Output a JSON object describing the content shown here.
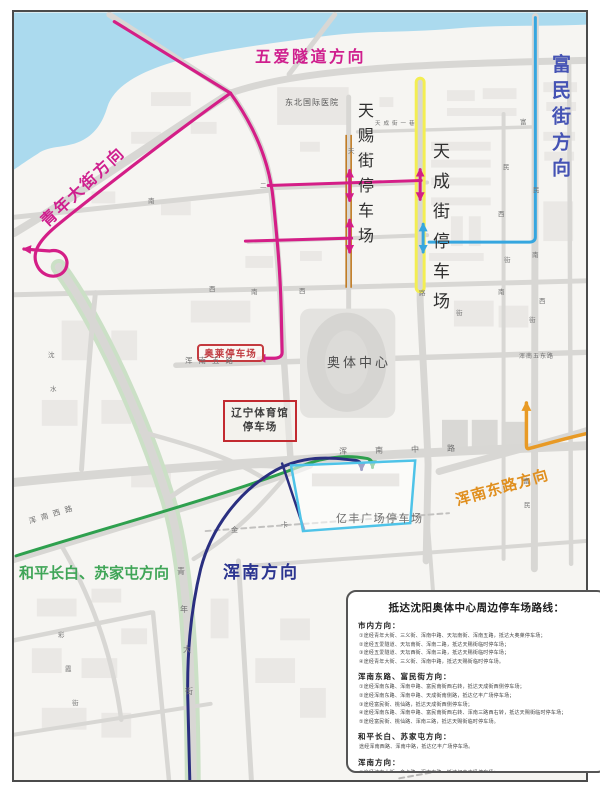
{
  "colors": {
    "route_magenta": "#d41e87",
    "route_blue": "#36a6df",
    "route_navy": "#2a2f80",
    "route_green": "#2ea04e",
    "route_orange": "#e89a25",
    "tianci_highlight_orange": "#c07a20",
    "tiancheng_highlight_yellow": "#f3ee52",
    "parking_box_red": "#c22a30",
    "yifeng_box_cyan": "#4ec3e8",
    "water": "#abdaee",
    "road": "#d8d7d4"
  },
  "map": {
    "parking": {
      "aolai": "奥莱停车场",
      "liaoning_line1": "辽宁体育馆",
      "liaoning_line2": "停车场",
      "yifeng": "亿丰广场停车场"
    },
    "labels": [
      {
        "name": "wuai-tunnel-direction-label",
        "text": "五爱隧道方向",
        "x": 253,
        "y": 47,
        "size": 16,
        "color": "#cf1f8e",
        "w": 700,
        "ls": 2.5
      },
      {
        "name": "fumin-street-direction-label",
        "text": "富民街方向",
        "x": 548,
        "y": 52,
        "size": 19,
        "color": "#4553b4",
        "w": 700,
        "ls": 7,
        "vert": true
      },
      {
        "name": "qingnian-street-direction-label",
        "text": "青年大街方向",
        "x": 36,
        "y": 216,
        "size": 16,
        "color": "#cf1f8e",
        "w": 700,
        "ls": 2,
        "rot": -43
      },
      {
        "name": "hunnan-east-road-direction-label",
        "text": "浑南东路方向",
        "x": 452,
        "y": 492,
        "size": 15,
        "color": "#e08f1f",
        "w": 700,
        "ls": 1,
        "rot": -16
      },
      {
        "name": "heping-changbai-sujiatun-direction-label",
        "text": "和平长白、苏家屯方向",
        "x": 17,
        "y": 564,
        "size": 15,
        "color": "#3fa557",
        "w": 700,
        "ls": 0
      },
      {
        "name": "hunnan-direction-label",
        "text": "浑南方向",
        "x": 221,
        "y": 563,
        "size": 17,
        "color": "#2c3590",
        "w": 700,
        "ls": 2
      },
      {
        "name": "tianci-street-parking-label",
        "text": "天赐街停车场",
        "x": 354,
        "y": 100,
        "size": 16,
        "color": "#2f2f2f",
        "w": 400,
        "ls": 9,
        "vert": true
      },
      {
        "name": "tiancheng-street-parking-label",
        "text": "天成街停车场",
        "x": 428,
        "y": 140,
        "size": 17,
        "color": "#2f2f2f",
        "w": 400,
        "ls": 13,
        "vert": true
      },
      {
        "name": "olympic-center-label",
        "text": "奥体中心",
        "x": 325,
        "y": 355,
        "size": 13,
        "color": "#4d4d4d",
        "w": 400,
        "ls": 3
      },
      {
        "name": "hospital-label",
        "text": "东北国际医院",
        "x": 283,
        "y": 97,
        "size": 8,
        "color": "#555555",
        "w": 400,
        "ls": 1
      },
      {
        "name": "road-label-hunnan-wulu",
        "text": "浑南五路",
        "x": 183,
        "y": 355,
        "size": 7.5,
        "color": "#6e6e6e",
        "w": 400,
        "ls": 6
      },
      {
        "name": "road-label-hunnan-wudonglu",
        "text": "浑南五东路",
        "x": 517,
        "y": 352,
        "size": 6,
        "color": "#6e6e6e",
        "w": 400,
        "ls": 1
      },
      {
        "name": "road-label-hunnan-zhonglu",
        "text": "浑南中路",
        "x": 337,
        "y": 446,
        "size": 8,
        "color": "#6e6e6e",
        "w": 400,
        "ls": 28,
        "rot": -1.5
      },
      {
        "name": "road-label-hunnan-xilu",
        "text": "浑南西路",
        "x": 26,
        "y": 516,
        "size": 7.5,
        "color": "#6e6e6e",
        "w": 400,
        "ls": 5,
        "rot": -17
      },
      {
        "name": "road-label-tiancheng-yixiang",
        "text": "天成街一巷",
        "x": 373,
        "y": 120,
        "size": 5.5,
        "color": "#6e6e6e",
        "w": 400,
        "ls": 3
      },
      {
        "name": "road-char",
        "text": "天",
        "x": 346,
        "y": 146,
        "size": 6.5,
        "color": "#757575"
      },
      {
        "name": "road-char",
        "text": "南",
        "x": 146,
        "y": 196,
        "size": 6.5,
        "color": "#757575"
      },
      {
        "name": "road-char",
        "text": "二",
        "x": 258,
        "y": 181,
        "size": 6.5,
        "color": "#757575"
      },
      {
        "name": "road-char",
        "text": "西",
        "x": 207,
        "y": 284,
        "size": 6.5,
        "color": "#757575"
      },
      {
        "name": "road-char",
        "text": "南",
        "x": 249,
        "y": 287,
        "size": 6.5,
        "color": "#757575"
      },
      {
        "name": "road-char",
        "text": "西",
        "x": 297,
        "y": 286,
        "size": 6.5,
        "color": "#757575"
      },
      {
        "name": "road-char",
        "text": "路",
        "x": 417,
        "y": 288,
        "size": 6.5,
        "color": "#757575"
      },
      {
        "name": "road-char",
        "text": "街",
        "x": 454,
        "y": 308,
        "size": 6.5,
        "color": "#757575"
      },
      {
        "name": "road-char",
        "text": "南",
        "x": 496,
        "y": 287,
        "size": 6.5,
        "color": "#757575"
      },
      {
        "name": "road-char",
        "text": "西",
        "x": 537,
        "y": 296,
        "size": 6.5,
        "color": "#757575"
      },
      {
        "name": "road-char",
        "text": "富",
        "x": 518,
        "y": 117,
        "size": 6.5,
        "color": "#757575"
      },
      {
        "name": "road-char",
        "text": "民",
        "x": 501,
        "y": 162,
        "size": 6.5,
        "color": "#757575"
      },
      {
        "name": "road-char",
        "text": "西",
        "x": 496,
        "y": 209,
        "size": 6.5,
        "color": "#757575"
      },
      {
        "name": "road-char",
        "text": "街",
        "x": 502,
        "y": 255,
        "size": 6.5,
        "color": "#757575"
      },
      {
        "name": "road-char",
        "text": "民",
        "x": 531,
        "y": 185,
        "size": 6.5,
        "color": "#757575"
      },
      {
        "name": "road-char",
        "text": "南",
        "x": 530,
        "y": 250,
        "size": 6.5,
        "color": "#757575"
      },
      {
        "name": "road-char",
        "text": "富",
        "x": 521,
        "y": 476,
        "size": 6.5,
        "color": "#757575"
      },
      {
        "name": "road-char",
        "text": "民",
        "x": 522,
        "y": 500,
        "size": 6.5,
        "color": "#757575"
      },
      {
        "name": "road-char",
        "text": "街",
        "x": 527,
        "y": 315,
        "size": 6.5,
        "color": "#757575"
      },
      {
        "name": "road-char",
        "text": "金",
        "x": 229,
        "y": 525,
        "size": 7,
        "color": "#757575"
      },
      {
        "name": "road-char",
        "text": "卡",
        "x": 279,
        "y": 520,
        "size": 7,
        "color": "#757575"
      },
      {
        "name": "road-char",
        "text": "青",
        "x": 175,
        "y": 566,
        "size": 8,
        "color": "#757575"
      },
      {
        "name": "road-char",
        "text": "年",
        "x": 178,
        "y": 604,
        "size": 8,
        "color": "#757575"
      },
      {
        "name": "road-char",
        "text": "大",
        "x": 181,
        "y": 644,
        "size": 8,
        "color": "#757575"
      },
      {
        "name": "road-char",
        "text": "街",
        "x": 183,
        "y": 686,
        "size": 8,
        "color": "#757575"
      },
      {
        "name": "road-char",
        "text": "彩",
        "x": 56,
        "y": 630,
        "size": 6.5,
        "color": "#757575"
      },
      {
        "name": "road-char",
        "text": "霞",
        "x": 63,
        "y": 664,
        "size": 6.5,
        "color": "#757575"
      },
      {
        "name": "road-char",
        "text": "街",
        "x": 70,
        "y": 698,
        "size": 6.5,
        "color": "#757575"
      },
      {
        "name": "road-char",
        "text": "沈",
        "x": 46,
        "y": 350,
        "size": 6.5,
        "color": "#757575"
      },
      {
        "name": "road-char",
        "text": "水",
        "x": 48,
        "y": 384,
        "size": 6.5,
        "color": "#757575"
      }
    ]
  },
  "legend": {
    "title": "抵达沈阳奥体中心周边停车场路线：",
    "sections": [
      {
        "header": "市内方向：",
        "lines": [
          "①途经青年大街、三义街、浑南中路、天坛南街、浑南五路，抵达大奥莱停车场；",
          "②途经五爱隧道、天坛南街、浑南二路，抵达天赐街临时停车场；",
          "③途经五爱隧道、天坛西街、浑南三路，抵达天赐街临时停车场；",
          "④途经青年大街、三义街、浑南中路，抵达天赐街临时停车场。"
        ]
      },
      {
        "header": "浑南东路、富民街方向：",
        "lines": [
          "①途经浑南东路、浑南中路、富民南街西右转，抵达天成街西侧停车场；",
          "②途经浑南东路、浑南中路、天成街南侧路，抵达亿丰广场停车场；",
          "③途经富民街、桃仙路，抵达天成街西侧停车场；",
          "④途经浑南东路、浑南中路、富民南街西右转、浑南三路西右转，抵达天赐街临时停车场；",
          "⑤途经富民街、桃仙路、浑南三路，抵达天赐街临时停车场。"
        ]
      },
      {
        "header": "和平长白、苏家屯方向：",
        "lines": [
          "途经浑南西路、浑南中路，抵达亿丰广场停车场。"
        ]
      },
      {
        "header": "浑南方向：",
        "lines": [
          "①途经沈本大街、金卡路、浑南中路，抵达亿丰广场停车场；",
          "②途经开发大道连接线、沈阳绕城高速、青年南大街、浑南中路，抵达亿丰广场停车场。"
        ]
      }
    ]
  }
}
